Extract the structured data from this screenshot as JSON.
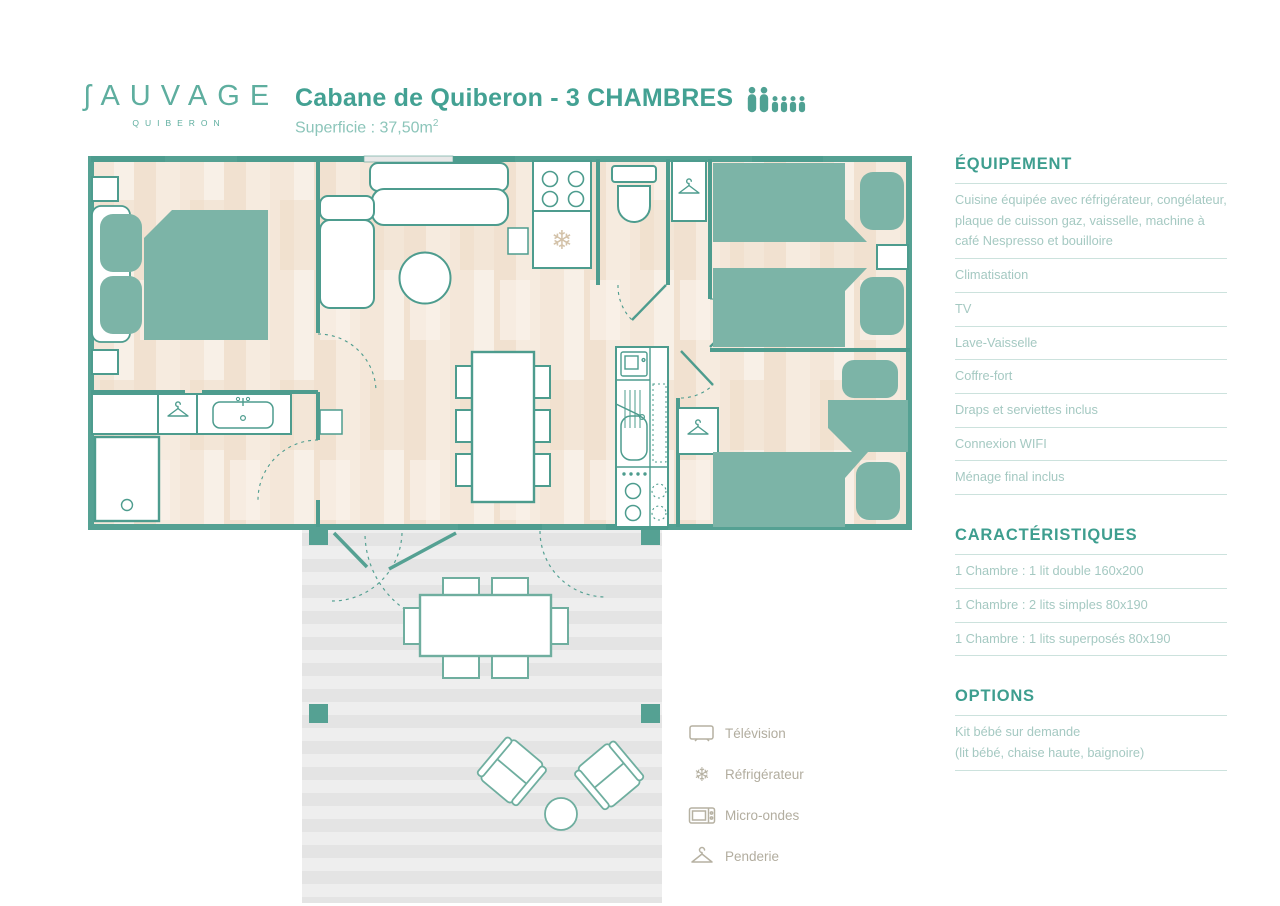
{
  "colors": {
    "wall_teal": "#4D9C8E",
    "wall_light": "#55A193",
    "furniture_teal": "#7CB4A7",
    "title_teal": "#43A193",
    "header_teal": "#3E9E8F",
    "item_text": "#A5C9C2",
    "divider": "#CCE2DD",
    "legend_gray": "#B2AD9F",
    "floor_cream": "#F7EEE4",
    "deck_gray": "#EAEAEA"
  },
  "header": {
    "logo": {
      "first": "ʃ",
      "rest": "AUVAGE",
      "place": "QUIBERON"
    },
    "title": "Cabane de Quiberon - 3 CHAMBRES",
    "capacity": {
      "adults": 2,
      "children": 4
    },
    "area_label": "Superficie : 37,50m",
    "area_sup": "2"
  },
  "panel": {
    "equipment": {
      "title": "ÉQUIPEMENT",
      "items": [
        "Cuisine équipée avec réfrigérateur, congélateur, plaque de cuisson gaz, vaisselle, machine à café Nespresso et bouilloire",
        "Climatisation",
        "TV",
        "Lave-Vaisselle",
        "Coffre-fort",
        "Draps et serviettes inclus",
        "Connexion WIFI",
        "Ménage final inclus"
      ]
    },
    "characteristics": {
      "title": "CARACTÉRISTIQUES",
      "items": [
        "1 Chambre : 1 lit double 160x200",
        "1 Chambre : 2 lits simples 80x190",
        "1 Chambre : 1 lits superposés 80x190"
      ]
    },
    "options": {
      "title": "OPTIONS",
      "line1": "Kit bébé sur demande",
      "line2": "(lit bébé, chaise haute, baignoire)"
    }
  },
  "legend": {
    "items": [
      {
        "icon": "tv-icon",
        "label": "Télévision"
      },
      {
        "icon": "snowflake-icon",
        "label": "Réfrigérateur"
      },
      {
        "icon": "microwave-icon",
        "label": "Micro-ondes"
      },
      {
        "icon": "hanger-icon",
        "label": "Penderie"
      }
    ]
  }
}
